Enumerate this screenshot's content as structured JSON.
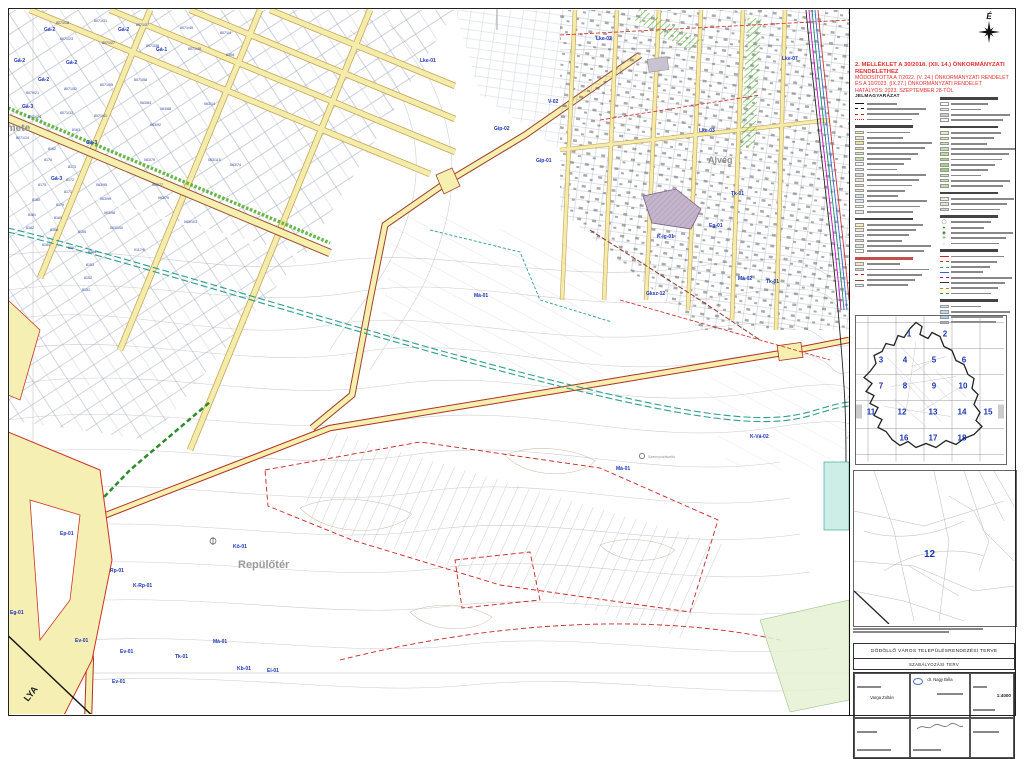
{
  "sheet": {
    "north_label": "É",
    "regulation_title_lines": [
      "2. MELLÉKLET A 30/2018. (XII. 14.) ÖNKORMÁNYZATI RENDELETHEZ",
      "MÓDOSÍTOTTA A 7/2022. (V. 24.) ÖNKORMÁNYZATI RENDELET",
      "ÉS A 10/2023. (IX.27.) ÖNKORMÁNYZATI RENDELET",
      "HATÁLYOS: 2023. SZEPTEMBER 28-TÓL"
    ],
    "red_color": "#e2302e",
    "zone_label_color": "#1a35b8",
    "road_fill_color": "#f5efb0",
    "railway_color": "#2a9d8f"
  },
  "legend": {
    "title": "JELMAGYARÁZAT",
    "columns": [
      {
        "sections": [
          {
            "has_title": true,
            "items": [
              {
                "k": "line",
                "c": "#111",
                "d": "solid"
              },
              {
                "k": "line",
                "c": "#111",
                "d": "dashed"
              },
              {
                "k": "line",
                "c": "#c02020",
                "d": "dashed"
              },
              {
                "k": "line",
                "c": "#c02020",
                "d": "dotted"
              }
            ]
          },
          {
            "items": [
              {
                "k": "fill",
                "c": "#f5eca6"
              },
              {
                "k": "fill",
                "c": "#f0e8c2"
              },
              {
                "k": "fill",
                "c": "#ece39e"
              },
              {
                "k": "fill",
                "c": "#dedc94"
              },
              {
                "k": "fill",
                "c": "#d2e6b2"
              },
              {
                "k": "fill",
                "c": "#c4e0a8"
              },
              {
                "k": "fill",
                "c": "#f0f0f0"
              },
              {
                "k": "fill",
                "c": "#e2e2e2"
              },
              {
                "k": "fill",
                "c": "#d5d5d5"
              },
              {
                "k": "fill",
                "c": "#f3dfc2"
              },
              {
                "k": "fill",
                "c": "#ecd2d2"
              },
              {
                "k": "fill",
                "c": "#e7e7bf"
              },
              {
                "k": "fill",
                "c": "#cfe4da"
              },
              {
                "k": "fill",
                "c": "#dce8f0"
              },
              {
                "k": "fill",
                "c": "#f7f3d0"
              },
              {
                "k": "fill",
                "c": "#e9e2ef"
              }
            ]
          },
          {
            "items": [
              {
                "k": "fill",
                "c": "#f7f0b0"
              },
              {
                "k": "fill",
                "c": "#efe6c8"
              },
              {
                "k": "fill",
                "c": "#e4e4e4"
              },
              {
                "k": "fill",
                "c": "#f0d8d8"
              },
              {
                "k": "fill",
                "c": "#d8e8d0"
              },
              {
                "k": "fill",
                "c": "#ffffff"
              }
            ]
          },
          {
            "header_red": true,
            "items": [
              {
                "k": "fill",
                "c": "#f2e6b4"
              },
              {
                "k": "fill",
                "c": "#dfd7c7"
              },
              {
                "k": "line",
                "c": "#c02020",
                "d": "dashed"
              },
              {
                "k": "line",
                "c": "#7a4a20",
                "d": "solid"
              },
              {
                "k": "fill",
                "c": "#e8e8f4"
              }
            ]
          }
        ]
      },
      {
        "sections": [
          {
            "items": [
              {
                "k": "fill",
                "c": "#ffffff"
              },
              {
                "k": "fill",
                "c": "#eeeeee"
              },
              {
                "k": "fill",
                "c": "#cccccc"
              },
              {
                "k": "fill",
                "c": "#f4f4f4"
              }
            ]
          },
          {
            "items": [
              {
                "k": "fill",
                "c": "#e3f0c8"
              },
              {
                "k": "fill",
                "c": "#d8ecba"
              },
              {
                "k": "fill",
                "c": "#cde8ad"
              },
              {
                "k": "fill",
                "c": "#c2e4a0"
              },
              {
                "k": "fill",
                "c": "#b7e093"
              },
              {
                "k": "fill",
                "c": "#addc86"
              },
              {
                "k": "fill",
                "c": "#a2d879"
              },
              {
                "k": "fill",
                "c": "#98d46c"
              },
              {
                "k": "fill",
                "c": "#d0e8c0"
              },
              {
                "k": "fill",
                "c": "#c6e4b3"
              },
              {
                "k": "fill",
                "c": "#bce0a6"
              }
            ]
          },
          {
            "items": [
              {
                "k": "fill",
                "c": "#e8f0d8"
              },
              {
                "k": "fill",
                "c": "#dcead0"
              },
              {
                "k": "fill",
                "c": "#d0e4c8"
              }
            ]
          },
          {
            "items": [
              {
                "k": "sym",
                "g": "◯"
              },
              {
                "k": "sym",
                "g": "●"
              },
              {
                "k": "sym",
                "g": "◉"
              },
              {
                "k": "sym",
                "g": "✳"
              },
              {
                "k": "sym",
                "g": "◌"
              }
            ]
          },
          {
            "items": [
              {
                "k": "line",
                "c": "#d02020",
                "d": "solid"
              },
              {
                "k": "line",
                "c": "#d02020",
                "d": "dashed"
              },
              {
                "k": "line",
                "c": "#2a9d8f",
                "d": "dashed"
              },
              {
                "k": "line",
                "c": "#3366cc",
                "d": "solid"
              },
              {
                "k": "line",
                "c": "#9900cc",
                "d": "dashed"
              },
              {
                "k": "line",
                "c": "#333333",
                "d": "solid"
              },
              {
                "k": "line",
                "c": "#cc8800",
                "d": "dashed"
              },
              {
                "k": "line",
                "c": "#339933",
                "d": "dashed"
              }
            ]
          },
          {
            "items": [
              {
                "k": "fill",
                "c": "#cfe6f4"
              },
              {
                "k": "fill",
                "c": "#bcd9ee"
              },
              {
                "k": "fill",
                "c": "#a8d0ea"
              },
              {
                "k": "fill",
                "c": "#9cc8e6"
              }
            ]
          }
        ]
      }
    ]
  },
  "overview_map": {
    "numbers": [
      {
        "n": "1",
        "x": 53,
        "y": 20
      },
      {
        "n": "2",
        "x": 89,
        "y": 20
      },
      {
        "n": "3",
        "x": 25,
        "y": 46
      },
      {
        "n": "4",
        "x": 49,
        "y": 46
      },
      {
        "n": "5",
        "x": 78,
        "y": 46
      },
      {
        "n": "6",
        "x": 108,
        "y": 46
      },
      {
        "n": "7",
        "x": 25,
        "y": 72
      },
      {
        "n": "8",
        "x": 49,
        "y": 72
      },
      {
        "n": "9",
        "x": 78,
        "y": 72
      },
      {
        "n": "10",
        "x": 107,
        "y": 72
      },
      {
        "n": "11",
        "x": 15,
        "y": 98
      },
      {
        "n": "12",
        "x": 46,
        "y": 98
      },
      {
        "n": "13",
        "x": 77,
        "y": 98
      },
      {
        "n": "14",
        "x": 106,
        "y": 98
      },
      {
        "n": "15",
        "x": 132,
        "y": 98
      },
      {
        "n": "16",
        "x": 48,
        "y": 124
      },
      {
        "n": "17",
        "x": 77,
        "y": 124
      },
      {
        "n": "18",
        "x": 106,
        "y": 124
      }
    ]
  },
  "detail_map": {
    "sheet_number": "12"
  },
  "title_block": {
    "title": "GÖDÖLLŐ VÁROS TELEPÜLÉSRENDEZÉSI TERVE",
    "subtitle": "SZABÁLYOZÁSI TERV",
    "scale": "1:4000",
    "architect": "dr. Nagy Béla",
    "designer": "Varga Zoltán"
  },
  "map": {
    "place_labels": [
      {
        "t": "Remete",
        "x": -6,
        "y": 131,
        "s": 10,
        "c": "#8f8f8f",
        "b": 1
      },
      {
        "t": "Alvég",
        "x": 708,
        "y": 163,
        "s": 9,
        "c": "#8f8f8f",
        "b": 1
      },
      {
        "t": "Repülőtér",
        "x": 238,
        "y": 568,
        "s": 11,
        "c": "#9a9a9a",
        "b": 1
      },
      {
        "t": "Szennyvíztisztító",
        "x": 648,
        "y": 458,
        "s": 3.6,
        "c": "#8f8f8f",
        "b": 0
      },
      {
        "t": "LYA",
        "x": 28,
        "y": 702,
        "s": 9,
        "c": "#1a1a1a",
        "b": 1,
        "r": -52
      }
    ],
    "zone_labels": [
      {
        "t": "Gá-2",
        "x": 44,
        "y": 31
      },
      {
        "t": "Gá-2",
        "x": 118,
        "y": 31
      },
      {
        "t": "Gá-2",
        "x": 14,
        "y": 62
      },
      {
        "t": "Gá-2",
        "x": 66,
        "y": 64
      },
      {
        "t": "Gá-2",
        "x": 38,
        "y": 81
      },
      {
        "t": "Gá-1",
        "x": 156,
        "y": 51
      },
      {
        "t": "Gá-3",
        "x": 22,
        "y": 108
      },
      {
        "t": "Gá-3",
        "x": 86,
        "y": 144
      },
      {
        "t": "Gá-3",
        "x": 51,
        "y": 180
      },
      {
        "t": "Lke-01",
        "x": 420,
        "y": 62
      },
      {
        "t": "Lke-02",
        "x": 596,
        "y": 40
      },
      {
        "t": "Lke-03",
        "x": 699,
        "y": 132
      },
      {
        "t": "Lke-07",
        "x": 782,
        "y": 60
      },
      {
        "t": "V-02",
        "x": 548,
        "y": 103
      },
      {
        "t": "Gip-02",
        "x": 494,
        "y": 130
      },
      {
        "t": "Gip-01",
        "x": 536,
        "y": 162
      },
      {
        "t": "Tk-01",
        "x": 731,
        "y": 195
      },
      {
        "t": "Eg-01",
        "x": 709,
        "y": 227
      },
      {
        "t": "K-íg-01",
        "x": 657,
        "y": 238
      },
      {
        "t": "Má-02",
        "x": 738,
        "y": 280
      },
      {
        "t": "Tk-01",
        "x": 766,
        "y": 283
      },
      {
        "t": "Gksz-12",
        "x": 646,
        "y": 295
      },
      {
        "t": "Má-01",
        "x": 474,
        "y": 297
      },
      {
        "t": "Má-01",
        "x": 616,
        "y": 470
      },
      {
        "t": "K-Vá-02",
        "x": 750,
        "y": 438
      },
      {
        "t": "Ep-01",
        "x": 60,
        "y": 535
      },
      {
        "t": "Rp-01",
        "x": 110,
        "y": 572
      },
      {
        "t": "K-Rp-01",
        "x": 133,
        "y": 587
      },
      {
        "t": "Kö-01",
        "x": 233,
        "y": 548
      },
      {
        "t": "Má-01",
        "x": 213,
        "y": 643
      },
      {
        "t": "Tk-01",
        "x": 175,
        "y": 658
      },
      {
        "t": "Ev-01",
        "x": 120,
        "y": 653
      },
      {
        "t": "Ev-01",
        "x": 112,
        "y": 683
      },
      {
        "t": "Eg-01",
        "x": 10,
        "y": 614
      },
      {
        "t": "Ev-01",
        "x": 75,
        "y": 642
      },
      {
        "t": "Kb-01",
        "x": 237,
        "y": 670
      },
      {
        "t": "Ei-01",
        "x": 267,
        "y": 672
      }
    ],
    "parcel_labels": [
      {
        "t": "8071/18",
        "x": 56,
        "y": 24
      },
      {
        "t": "8071/31",
        "x": 94,
        "y": 22
      },
      {
        "t": "8071/37",
        "x": 136,
        "y": 26
      },
      {
        "t": "8071/45",
        "x": 180,
        "y": 29
      },
      {
        "t": "8071/4",
        "x": 220,
        "y": 34
      },
      {
        "t": "8071/23",
        "x": 60,
        "y": 40
      },
      {
        "t": "8071/27",
        "x": 102,
        "y": 44
      },
      {
        "t": "8071/38",
        "x": 146,
        "y": 47
      },
      {
        "t": "8071/48",
        "x": 188,
        "y": 50
      },
      {
        "t": "8304",
        "x": 226,
        "y": 56
      },
      {
        "t": "8079/21",
        "x": 26,
        "y": 94
      },
      {
        "t": "8071/52",
        "x": 64,
        "y": 90
      },
      {
        "t": "8071/55",
        "x": 100,
        "y": 86
      },
      {
        "t": "8071/58",
        "x": 134,
        "y": 81
      },
      {
        "t": "8071/24",
        "x": 28,
        "y": 118
      },
      {
        "t": "8071/33",
        "x": 60,
        "y": 114
      },
      {
        "t": "8071/41",
        "x": 94,
        "y": 117
      },
      {
        "t": "8071/14",
        "x": 16,
        "y": 139
      },
      {
        "t": "8163",
        "x": 72,
        "y": 131
      },
      {
        "t": "8162",
        "x": 48,
        "y": 150
      },
      {
        "t": "8174",
        "x": 44,
        "y": 161
      },
      {
        "t": "8173",
        "x": 68,
        "y": 168
      },
      {
        "t": "8172",
        "x": 66,
        "y": 181
      },
      {
        "t": "8171",
        "x": 64,
        "y": 193
      },
      {
        "t": "8175",
        "x": 38,
        "y": 186
      },
      {
        "t": "8180",
        "x": 32,
        "y": 201
      },
      {
        "t": "8179",
        "x": 56,
        "y": 206
      },
      {
        "t": "8181",
        "x": 28,
        "y": 216
      },
      {
        "t": "8169",
        "x": 54,
        "y": 219
      },
      {
        "t": "8182",
        "x": 26,
        "y": 229
      },
      {
        "t": "8168",
        "x": 50,
        "y": 231
      },
      {
        "t": "8155",
        "x": 78,
        "y": 233
      },
      {
        "t": "8184",
        "x": 42,
        "y": 246
      },
      {
        "t": "8167",
        "x": 68,
        "y": 249
      },
      {
        "t": "8154",
        "x": 88,
        "y": 253
      },
      {
        "t": "8153",
        "x": 86,
        "y": 266
      },
      {
        "t": "8152",
        "x": 84,
        "y": 279
      },
      {
        "t": "8151",
        "x": 82,
        "y": 291
      },
      {
        "t": "063/95",
        "x": 96,
        "y": 186
      },
      {
        "t": "063/99",
        "x": 100,
        "y": 200
      },
      {
        "t": "063/98",
        "x": 104,
        "y": 214
      },
      {
        "t": "063/100",
        "x": 110,
        "y": 229
      },
      {
        "t": "063/84",
        "x": 140,
        "y": 104
      },
      {
        "t": "063/88",
        "x": 160,
        "y": 110
      },
      {
        "t": "063/92",
        "x": 150,
        "y": 126
      },
      {
        "t": "063/14",
        "x": 204,
        "y": 105
      },
      {
        "t": "063/79",
        "x": 144,
        "y": 161
      },
      {
        "t": "063/77",
        "x": 152,
        "y": 186
      },
      {
        "t": "063/75",
        "x": 158,
        "y": 199
      },
      {
        "t": "063/115",
        "x": 208,
        "y": 161
      },
      {
        "t": "063/74",
        "x": 230,
        "y": 166
      },
      {
        "t": "063/103",
        "x": 184,
        "y": 223
      },
      {
        "t": "0117/6",
        "x": 134,
        "y": 251
      }
    ]
  }
}
